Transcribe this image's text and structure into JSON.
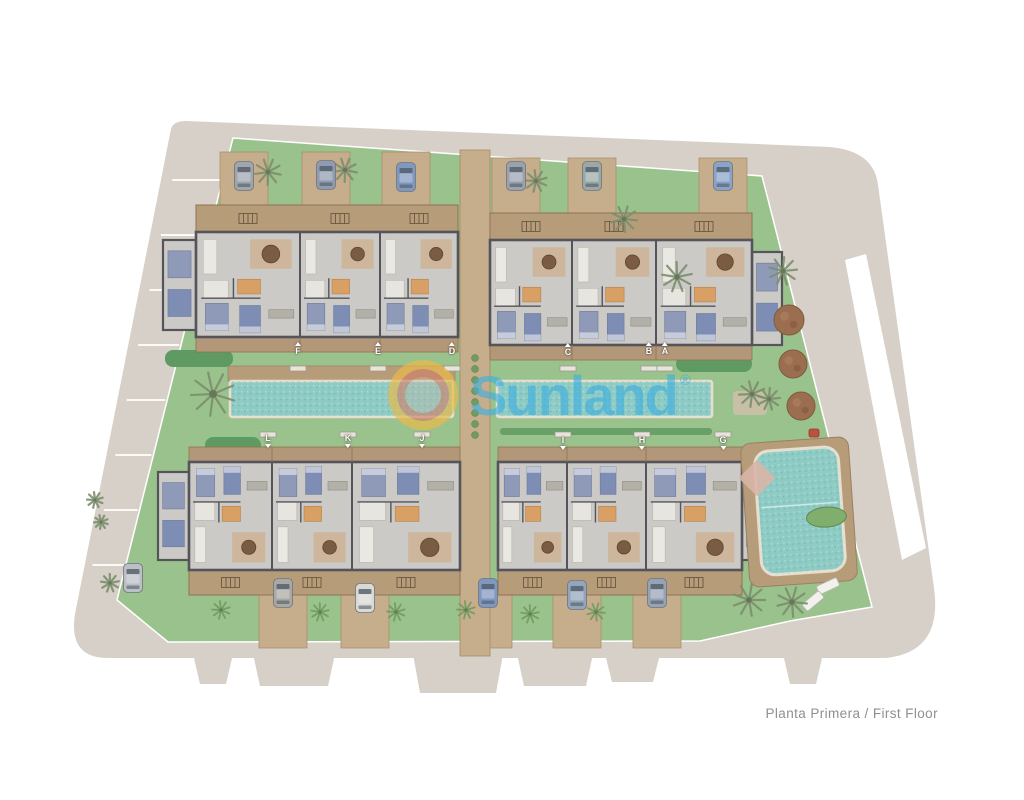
{
  "page": {
    "title_label": "Planta Primera / First Floor"
  },
  "logo": {
    "text": "Sunland",
    "registered": "®"
  },
  "palette": {
    "road": "#d7d0c8",
    "lawn": "#9ac28c",
    "lawn_dark": "#5f9a62",
    "wood": "#b79c7a",
    "wood_light": "#c6ae8c",
    "wood_dark": "#8d7352",
    "wall": "#55545b",
    "floor": "#cbcac6",
    "water": "#8ecbc4",
    "water_edge": "#e6dfd0",
    "white_line": "#ffffff",
    "tree_brown": "#9c6e50",
    "palm": "#7d8f6e",
    "shrub": "#6f9c5e",
    "label_text": "#ffffff",
    "title_text": "#8f8f8f",
    "logo_blue": "rgba(62,174,224,0.62)",
    "sun_yellow": "rgba(247,188,40,0.5)",
    "sun_orange": "rgba(220,100,72,0.42)",
    "sun_center": "rgba(196,180,164,0.38)"
  },
  "site": {
    "outline": "M 186,121 L 830,147 Q 874,151 878,185 L 934,588 Q 943,652 886,658 L 108,658 Q 68,658 75,614 L 171,129 Q 173,121 186,121 Z",
    "bottom_tabs": [
      [
        193,
        233,
        684
      ],
      [
        253,
        335,
        686
      ],
      [
        413,
        503,
        693
      ],
      [
        517,
        593,
        686
      ],
      [
        605,
        660,
        682
      ],
      [
        783,
        823,
        684
      ]
    ],
    "outside_wedge": "845,260 866,254 926,548 902,560",
    "property_line": "233,138 762,176 872,607 790,621 700,641 168,642 117,600",
    "parking_line_ys": [
      180,
      235,
      290,
      345,
      400,
      455,
      510,
      565
    ]
  },
  "courtyard": {
    "lap_pools": [
      [
        230,
        381,
        223,
        36
      ],
      [
        497,
        381,
        215,
        36
      ]
    ],
    "sun_deck": [
      228,
      366,
      227,
      15
    ],
    "hedge": [
      500,
      428,
      212,
      7
    ],
    "path": {
      "x": 460,
      "w": 30,
      "y1": 150,
      "y2": 656,
      "plant_cx": 475,
      "plants_y0": 358,
      "plants_y1": 445,
      "plants_step": 11
    },
    "green_caps": [
      [
        165,
        350,
        68,
        17
      ],
      [
        676,
        356,
        76,
        16
      ],
      [
        205,
        437,
        56,
        16
      ]
    ]
  },
  "communal_pool": {
    "deck": [
      745,
      440,
      108,
      144
    ],
    "pool": [
      758,
      449,
      84,
      124
    ],
    "rotation": -4,
    "planter": [
      826,
      519,
      20,
      10
    ],
    "lane_y": 505,
    "loungers": [
      [
        828,
        586,
        -25
      ],
      [
        813,
        601,
        -40
      ]
    ],
    "blanket": [
      757,
      478
    ],
    "patch": [
      733,
      391,
      34,
      24
    ],
    "grill": [
      814,
      433
    ]
  },
  "blocks": [
    {
      "name": "upper-left",
      "x": 196,
      "w": 262,
      "deck": [
        205,
        27
      ],
      "bldg": [
        232,
        105
      ],
      "terr": [
        337,
        15
      ],
      "walls": [
        300,
        380
      ],
      "units": [
        "F",
        "E",
        "D"
      ],
      "wing": [
        163,
        240,
        33,
        90
      ],
      "orient": "up"
    },
    {
      "name": "upper-right",
      "x": 490,
      "w": 262,
      "deck": [
        213,
        27
      ],
      "bldg": [
        240,
        105
      ],
      "terr": [
        345,
        15
      ],
      "walls": [
        572,
        656
      ],
      "units": [
        "C",
        "B",
        "A"
      ],
      "wing": [
        752,
        252,
        30,
        93
      ],
      "orient": "up"
    },
    {
      "name": "lower-left",
      "x": 189,
      "w": 271,
      "terr": [
        447,
        15
      ],
      "bldg": [
        462,
        108
      ],
      "deck": [
        570,
        25
      ],
      "walls": [
        272,
        352
      ],
      "units": [
        "L",
        "K",
        "J"
      ],
      "wing": [
        158,
        472,
        31,
        88
      ],
      "orient": "down"
    },
    {
      "name": "lower-right",
      "x": 498,
      "w": 244,
      "terr": [
        447,
        15
      ],
      "bldg": [
        462,
        108
      ],
      "deck": [
        570,
        25
      ],
      "walls": [
        567,
        646
      ],
      "units": [
        "I",
        "H",
        "G"
      ],
      "wing": [
        742,
        472,
        30,
        88
      ],
      "orient": "down"
    }
  ],
  "driveways": [
    {
      "y": 152,
      "h": 56,
      "w": 48,
      "centers": [
        244,
        326,
        406
      ]
    },
    {
      "y": 158,
      "h": 56,
      "w": 48,
      "centers": [
        516,
        592,
        723
      ]
    },
    {
      "y": 594,
      "h": 54,
      "w": 48,
      "centers": [
        283,
        365,
        488,
        577,
        657
      ]
    }
  ],
  "cars": [
    {
      "x": 244,
      "y": 176,
      "c": "#9fa6ad"
    },
    {
      "x": 326,
      "y": 175,
      "c": "#8e9bb0"
    },
    {
      "x": 406,
      "y": 177,
      "c": "#7f98c0"
    },
    {
      "x": 516,
      "y": 176,
      "c": "#9aa3ad"
    },
    {
      "x": 592,
      "y": 176,
      "c": "#9aa9a8"
    },
    {
      "x": 723,
      "y": 176,
      "c": "#8aa3c8"
    },
    {
      "x": 133,
      "y": 578,
      "c": "#bcc0c6"
    },
    {
      "x": 283,
      "y": 593,
      "c": "#a8a9a4"
    },
    {
      "x": 365,
      "y": 598,
      "c": "#d9d9d5"
    },
    {
      "x": 488,
      "y": 593,
      "c": "#7f98c0"
    },
    {
      "x": 577,
      "y": 595,
      "c": "#93a5bc"
    },
    {
      "x": 657,
      "y": 593,
      "c": "#96a3b4"
    }
  ],
  "trees": {
    "round": [
      [
        789,
        320,
        15
      ],
      [
        793,
        364,
        14
      ],
      [
        801,
        406,
        14
      ]
    ],
    "palms": [
      [
        268,
        172,
        13
      ],
      [
        345,
        170,
        12
      ],
      [
        536,
        181,
        11
      ],
      [
        624,
        219,
        13
      ],
      [
        677,
        277,
        15
      ],
      [
        783,
        271,
        14
      ],
      [
        213,
        394,
        22
      ],
      [
        752,
        394,
        13
      ],
      [
        769,
        399,
        11
      ],
      [
        749,
        600,
        16
      ],
      [
        792,
        602,
        15
      ],
      [
        110,
        583,
        9
      ],
      [
        95,
        500,
        8
      ],
      [
        101,
        522,
        7
      ]
    ],
    "shrubs": [
      [
        221,
        610,
        9
      ],
      [
        320,
        612,
        9
      ],
      [
        396,
        612,
        9
      ],
      [
        466,
        610,
        9
      ],
      [
        530,
        614,
        9
      ],
      [
        596,
        612,
        9
      ]
    ]
  },
  "unit_labels": {
    "upper": [
      {
        "letter": "F",
        "x": 298,
        "y": 349
      },
      {
        "letter": "E",
        "x": 378,
        "y": 349
      },
      {
        "letter": "D",
        "x": 452,
        "y": 349
      },
      {
        "letter": "C",
        "x": 568,
        "y": 350
      },
      {
        "letter": "B",
        "x": 649,
        "y": 349
      },
      {
        "letter": "A",
        "x": 665,
        "y": 349
      }
    ],
    "lower": [
      {
        "letter": "L",
        "x": 268,
        "y": 441
      },
      {
        "letter": "K",
        "x": 348,
        "y": 441
      },
      {
        "letter": "J",
        "x": 422,
        "y": 441
      },
      {
        "letter": "I",
        "x": 563,
        "y": 443
      },
      {
        "letter": "H",
        "x": 642,
        "y": 443
      },
      {
        "letter": "G",
        "x": 723,
        "y": 443
      }
    ],
    "step_upper_y": 366,
    "step_lower_y": 432
  }
}
